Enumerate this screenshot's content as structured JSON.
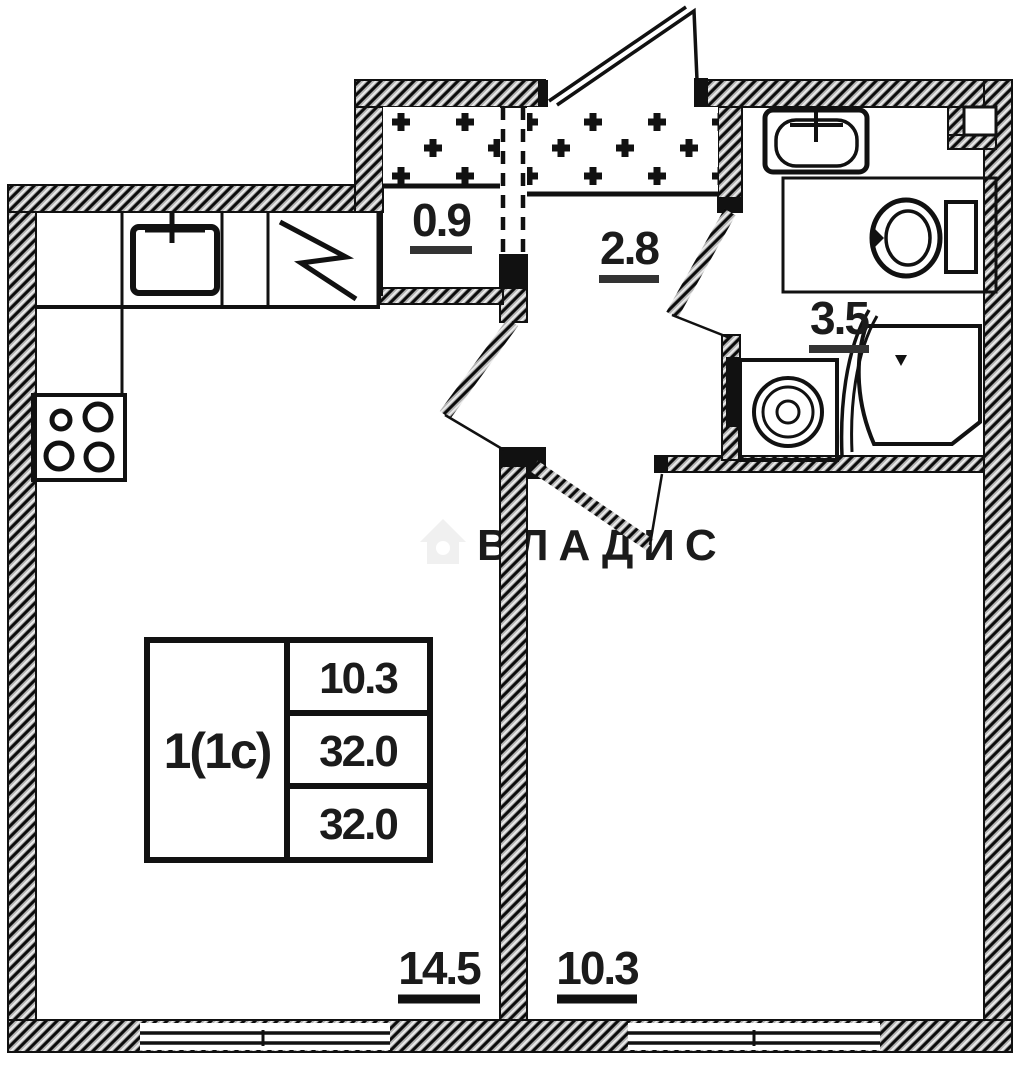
{
  "plan": {
    "title": "apartment-floor-plan",
    "rooms": [
      {
        "id": "closet",
        "area_label": "0.9"
      },
      {
        "id": "hallway",
        "area_label": "2.8"
      },
      {
        "id": "bathroom",
        "area_label": "3.5"
      },
      {
        "id": "kitchen-living-room",
        "area_label": "14.5"
      },
      {
        "id": "bedroom",
        "area_label": "10.3"
      }
    ],
    "info_table": {
      "apartment_type": "1(1с)",
      "rows": [
        "10.3",
        "32.0",
        "32.0"
      ]
    },
    "fixtures": [
      "kitchen-sink-icon",
      "fridge-icon",
      "stove-icon",
      "bath-sink-icon",
      "toilet-icon",
      "washing-machine-icon",
      "shower-icon",
      "wardrobe-hatch-left",
      "wardrobe-hatch-right"
    ]
  },
  "watermark": {
    "brand": "ВЛАДИС",
    "icon": "house-icon"
  },
  "colors": {
    "line": "#151515",
    "wall_fill": "#b4b4b4",
    "background": "#ffffff",
    "watermark": "#f0f0f0"
  }
}
